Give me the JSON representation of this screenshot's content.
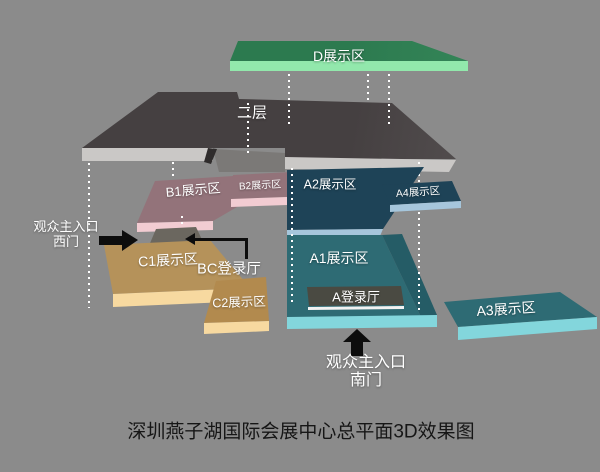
{
  "diagram": {
    "caption": "深圳燕子湖国际会展中心总平面3D效果图",
    "background_color": "#8b8b8b",
    "column_dot_color": "#ffffff"
  },
  "floors": {
    "second": {
      "label": "二层",
      "top_color": "#454041",
      "edge_color": "#cac8c6"
    }
  },
  "zones": {
    "d": {
      "label": "D展示区",
      "top_color": "#2e7d52",
      "edge_color": "#92e8ac"
    },
    "b1": {
      "label": "B1展示区",
      "top_color": "#93737a",
      "edge_color": "#f2ccd2"
    },
    "b2": {
      "label": "B2展示区",
      "top_color": "#93737a",
      "edge_color": "#f2ccd2"
    },
    "a1": {
      "label": "A1展示区",
      "top_color": "#2e6b74",
      "edge_color": "#83d6dc"
    },
    "a2": {
      "label": "A2展示区",
      "top_color": "#1e4357",
      "edge_color": "#a6c6dc"
    },
    "a3": {
      "label": "A3展示区",
      "top_color": "#2e6b74",
      "edge_color": "#83d6dc"
    },
    "a4": {
      "label": "A4展示区",
      "top_color": "#1e4357",
      "edge_color": "#a6c6dc"
    },
    "c1": {
      "label": "C1展示区",
      "top_color": "#b28a4e",
      "edge_color": "#f7d9a0"
    },
    "c2": {
      "label": "C2展示区",
      "top_color": "#b28a4e",
      "edge_color": "#f7d9a0"
    }
  },
  "halls": {
    "a_hall": {
      "label": "A登录厅",
      "color": "#4a4a42"
    },
    "bc_hall": {
      "label": "BC登录厅"
    }
  },
  "entrances": {
    "west": {
      "line1": "观众主入口",
      "line2": "西门",
      "arrow_direction": "right"
    },
    "south": {
      "line1": "观众主入口",
      "line2": "南门",
      "arrow_direction": "up"
    }
  }
}
